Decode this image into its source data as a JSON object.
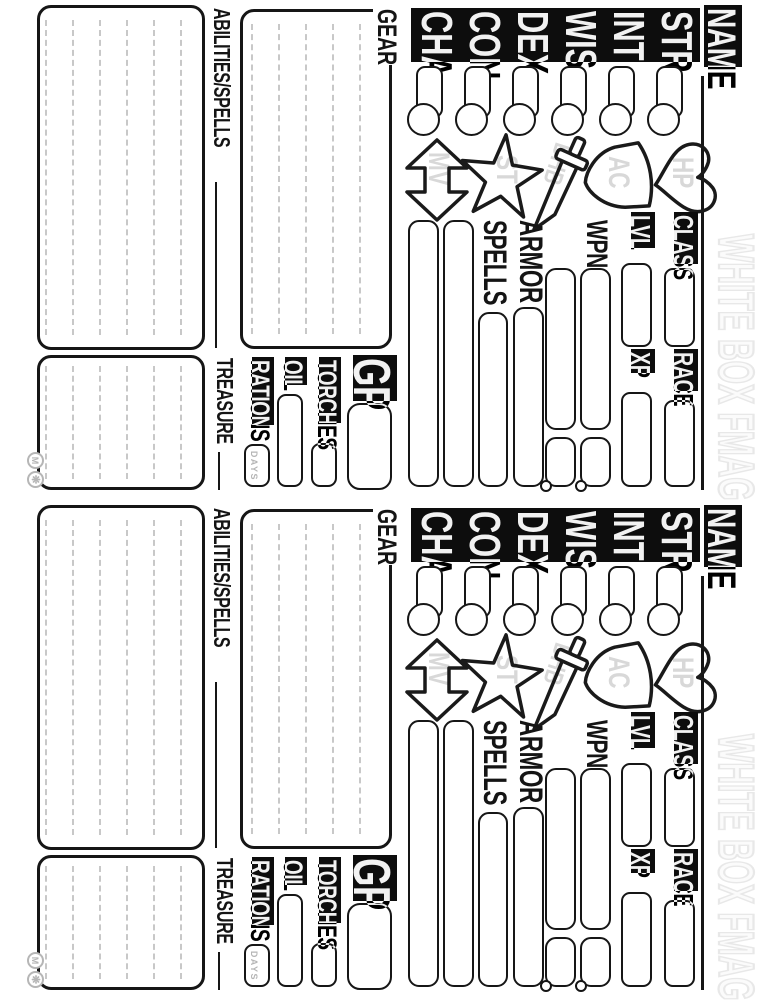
{
  "page": {
    "copies": 2,
    "watermark": "WHITE BOX FMAG"
  },
  "sheet": {
    "name_label": "NAME",
    "abilities": [
      "STR",
      "INT",
      "WIS",
      "DEX",
      "CON",
      "CHA"
    ],
    "stat_icons": [
      {
        "icon": "heart",
        "stat": "HP"
      },
      {
        "icon": "shield",
        "stat": "AC"
      },
      {
        "icon": "sword",
        "stat": "BHB"
      },
      {
        "icon": "star",
        "stat": "ST"
      },
      {
        "icon": "double-arrow",
        "stat": "MV"
      }
    ],
    "fields": {
      "class": "CLASS",
      "level": "LVL",
      "race": "RACE",
      "xp": "XP"
    },
    "gear_list": {
      "weapon": "WPN",
      "armor": "ARMOR",
      "spells": "SPELLS"
    },
    "supplies": {
      "gp": "GP",
      "torches": "TORCHES",
      "oil": "OIL",
      "rations": "RATIONS",
      "rations_unit": "DAYS"
    },
    "sections": {
      "gear": "GEAR",
      "abilities_spells": "ABILITIES/SPELLS",
      "treasure": "TREASURE"
    },
    "stamps": [
      "M",
      "❋"
    ],
    "colors": {
      "ink": "#141414",
      "ghost_text": "#d8d8d8",
      "ruled_line": "#c8c8c8",
      "watermark": "#e8e8e8"
    }
  }
}
